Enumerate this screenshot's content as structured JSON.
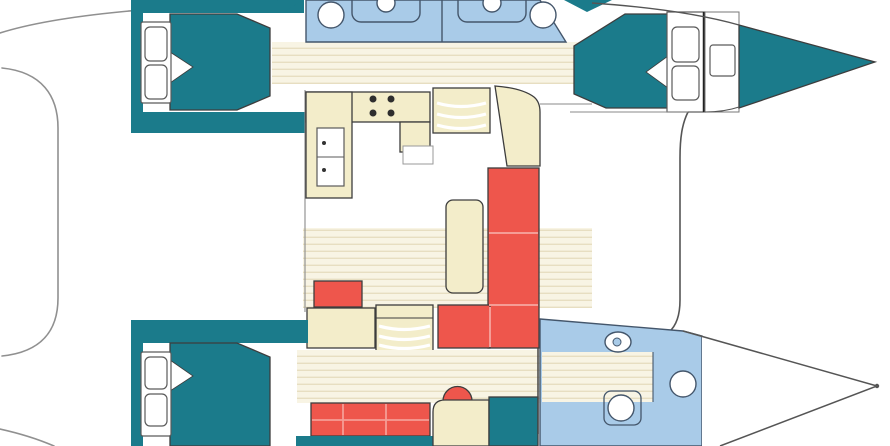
{
  "page": {
    "width_px": 890,
    "height_px": 446,
    "description": "Top-down interior layout plan of a sailing catamaran, bow pointing right, no text labels"
  },
  "colors": {
    "background": "#ffffff",
    "cabin_teal": "#1b7b8b",
    "bathroom_blue": "#a9cbe8",
    "furniture_beige": "#f3edca",
    "upholstery_red": "#ee564c",
    "floor_cream": "#f8f4e4",
    "floor_plank_line": "#e7dec1",
    "outline_dark": "#3d3d3d",
    "hull_line_gray": "#909090",
    "fixture_stroke": "#44566b",
    "red_seam": "#f59d96",
    "fixture_white": "#ffffff"
  },
  "legend": {
    "cabin_teal": "double berths, bow lockers and joinery",
    "bathroom_blue": "head / shower compartments",
    "furniture_beige": "galley, steps, table and desks",
    "upholstery_red": "sofas, settees and stools",
    "floor_cream": "plank flooring in corridors and saloon"
  },
  "plan": {
    "orientation": "bow-right",
    "port_hull": [
      "aft double berth with side steps",
      "two head compartments with sink, toilet and shower",
      "plank corridor",
      "forward double berth with side steps",
      "forepeak anchor locker with hatch",
      "teal bow"
    ],
    "saloon": [
      "L-shaped galley with 4-burner stove and sink cabinet",
      "curved companionway steps to port hull",
      "white landing",
      "corner cabinet",
      "dining table",
      "L-shaped red sofa with seams",
      "red ottoman",
      "storage cabinet",
      "curved companionway steps to starboard hull"
    ],
    "starboard_hull": [
      "aft double berth with side steps",
      "plank corridor",
      "red settee",
      "desk with red half-round stool",
      "teal wardrobe",
      "forward head with toilet and two basins",
      "white bow"
    ],
    "deck": [
      "port sheer line",
      "starboard sheer line",
      "aft platform outline",
      "forward crossbeam line"
    ]
  }
}
